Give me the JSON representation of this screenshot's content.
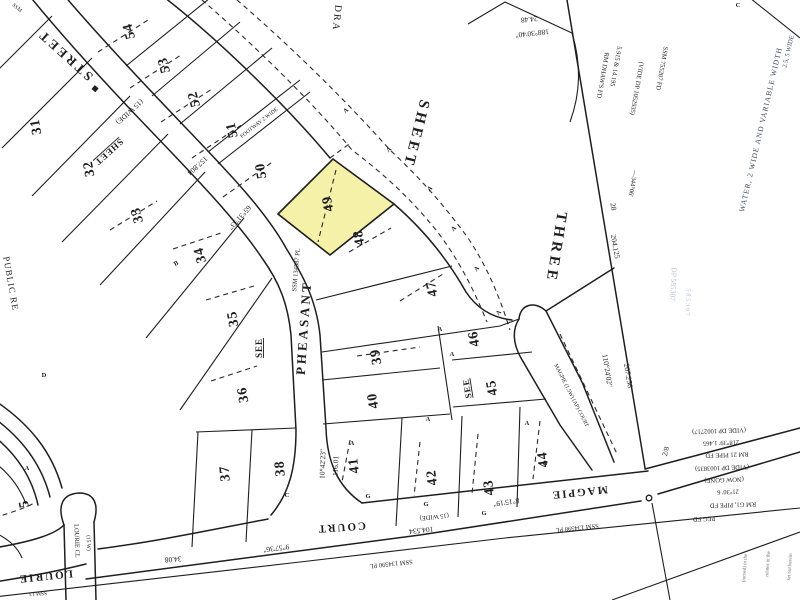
{
  "map": {
    "type": "cadastral-survey-plan",
    "highlighted_lot": "49",
    "colors": {
      "paper": "#ffffff",
      "ink": "#1e1e1e",
      "highlight": "#f5f1a8",
      "faint_blue": "#8596bb",
      "note_blue": "#3f4a63"
    },
    "lots": {
      "l5": "5",
      "l31": "31",
      "l32": "32",
      "l33": "33",
      "l34": "34",
      "l35": "35",
      "l36": "36",
      "l37": "37",
      "l38": "38",
      "l39": "39",
      "l40": "40",
      "l41": "41",
      "l42": "42",
      "l43": "43",
      "l44": "44",
      "l45": "45",
      "l46": "46",
      "l47": "47",
      "l48": "48",
      "l49": "49",
      "l50": "50",
      "l51": "51",
      "l52": "52",
      "l53": "53",
      "l54": "54"
    },
    "streets": {
      "street": "STREET",
      "pheasant": "PHEASANT",
      "court": "COURT",
      "magpie": "MAGPIE",
      "lourie": "LOURIE",
      "lourie_cl": "LOURIE CL",
      "lourie_cl_width": "(15 W)",
      "lane": "MAGPIE (1.5W) (AP) COURT",
      "public_reserve": "PUBLIC RE",
      "footway": "FOOTWAY 2 WIDE",
      "width_top": "(15 WIDE)",
      "width_bottom": "(15 WIDE)"
    },
    "sheet": {
      "dra": "DRA",
      "sheet_big": "SHEET",
      "three": "THREE",
      "sheet_small": "SHEET",
      "see_left": "SEE",
      "see_mid": "SEE"
    },
    "dims": {
      "b6531": "65°31'53\"",
      "d157": "157.804",
      "b1042": "10°42'23\"",
      "d116": "116.01",
      "d104": "104.534",
      "b957": "9°57'36\"",
      "d3408": "34.08",
      "b815": "8°15'19\"",
      "d2448": "24.48",
      "b1883040": "188°30'40\"",
      "d204": "204.125",
      "d28": "28",
      "b11024": "110°24'02\"",
      "d207": "207.256",
      "b34406": "—344°06'",
      "d5915": "5.915 & 14.195",
      "frac": "2/8"
    },
    "marks": {
      "ssm134587": "SSM 134587 PL",
      "ssm134590": "SSM 134590 PL",
      "ssm134598": "SSM 134598 PL",
      "ssm755207": "SSM 755207 FD",
      "ssm_corner": "SSM",
      "ssm_partial": "SSM 13",
      "rm_dhaws": "RM DHAW'S FD",
      "vide1052935": "(VIDE DP 1052935)",
      "dp585307": "DP 585307",
      "dp585307b": "5 8 5 3 0 7"
    },
    "easement_note": {
      "water": "WATER, 2 WIDE AND VARIABLE WIDTH",
      "wide": "2.5, 5 WIDE"
    },
    "peg_block": [
      "(VIDE DP 1002717)",
      "218°39' 1.465",
      "RM 21 PIPE FD",
      "(VIDE DP 1003835)",
      "(NOW GONE)",
      "21°30' 6",
      "RM G1, PIPE FD",
      "PEG FD"
    ],
    "side_notes": [
      "(turned) in the",
      "relates in the",
      "set out herein"
    ],
    "letter_markers": [
      "A",
      "A",
      "A",
      "A",
      "A",
      "A",
      "A",
      "A",
      "A",
      "A",
      "A",
      "G",
      "G",
      "G",
      "G",
      "B",
      "C",
      "D",
      "A",
      "C"
    ]
  }
}
